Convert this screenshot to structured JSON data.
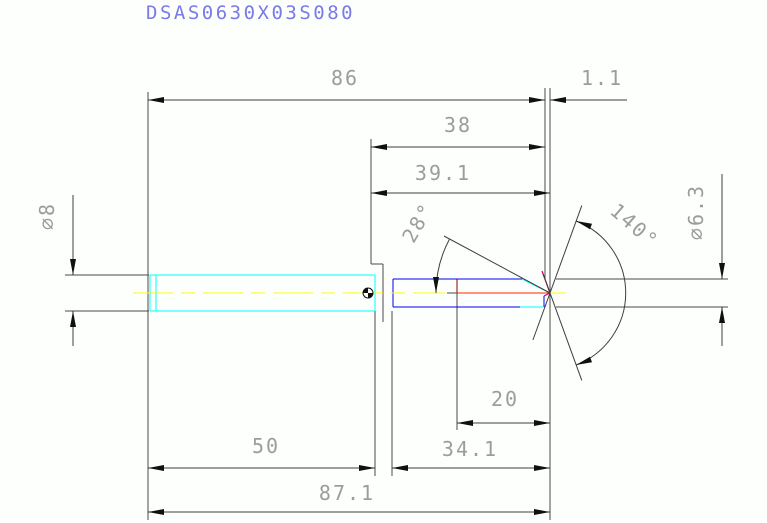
{
  "title": "DSAS0630X03S080",
  "colors": {
    "background": "#fcfffc",
    "title_text": "#7a7ae8",
    "dimension_lines": "#3e3e3e",
    "dimension_text": "#9c9c9c",
    "arrowheads": "#101010",
    "shank_outline": "#00ffff",
    "body_outline": "#0000ee",
    "centerline": "#ffff00",
    "pilot_centerline": "#ff2400",
    "step_mark": "#8b0000",
    "tip_edge_accent": "#cc0066"
  },
  "dimensions": {
    "overall_length": "86",
    "tip_length": "1.1",
    "flute_length": "38",
    "step_length_a": "39.1",
    "pilot_length": "20",
    "step_length_b": "34.1",
    "shank_length": "50",
    "total_length": "87.1",
    "shank_diameter": "⌀8",
    "body_diameter": "⌀6.3",
    "secondary_angle": "28°",
    "point_angle": "140°"
  }
}
